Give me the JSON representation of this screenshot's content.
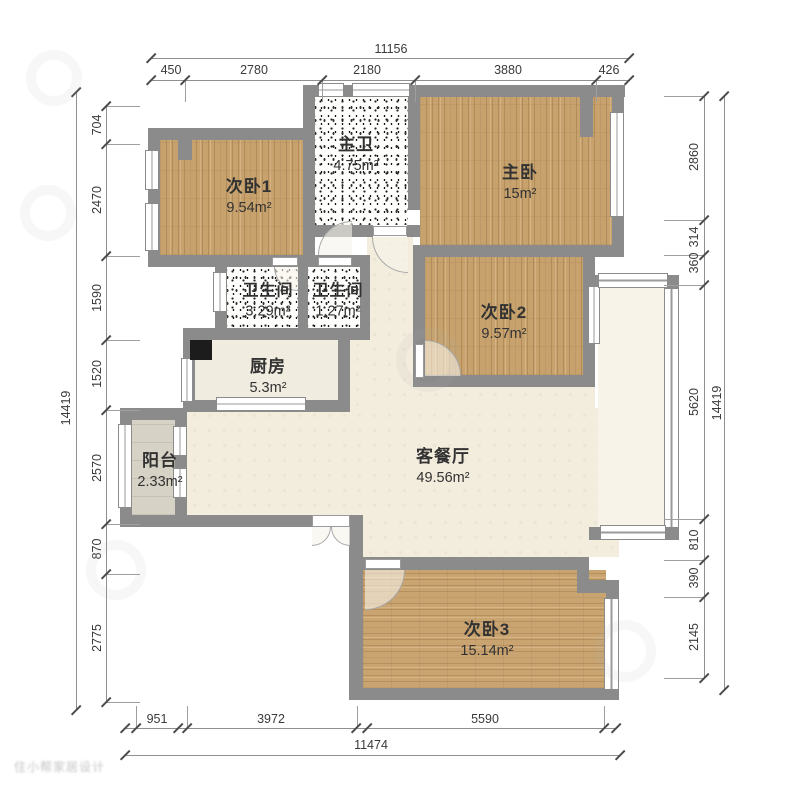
{
  "plan": {
    "rooms": [
      {
        "name": "次卧1",
        "area": "9.54m²"
      },
      {
        "name": "主卫",
        "area": "4.75m²"
      },
      {
        "name": "主卧",
        "area": "15m²"
      },
      {
        "name": "次卧2",
        "area": "9.57m²"
      },
      {
        "name": "卫生间",
        "area": "3.29m²"
      },
      {
        "name": "卫生间",
        "area": "1.27m²"
      },
      {
        "name": "厨房",
        "area": "5.3m²"
      },
      {
        "name": "阳台",
        "area": "2.33m²"
      },
      {
        "name": "客餐厅",
        "area": "49.56m²"
      },
      {
        "name": "次卧3",
        "area": "15.14m²"
      }
    ],
    "dimensions": {
      "top": {
        "total": "11156",
        "segments": [
          "450",
          "2780",
          "2180",
          "3880",
          "426"
        ]
      },
      "bottom": {
        "total": "11474",
        "segments": [
          "951",
          "3972",
          "5590"
        ]
      },
      "left": {
        "total": "14419",
        "segments": [
          "704",
          "2470",
          "1590",
          "1520",
          "2570",
          "870",
          "2775"
        ]
      },
      "right": {
        "total": "14419",
        "segments": [
          "2860",
          "314",
          "360",
          "5620",
          "810",
          "390",
          "2145"
        ]
      }
    },
    "watermark": "住小帮家居设计",
    "colors": {
      "wall": "#8b8b8b",
      "wood_floor": "#c7a26d",
      "tile_floor": "#f3edde",
      "balcony_floor": "#d6d2c6"
    }
  }
}
